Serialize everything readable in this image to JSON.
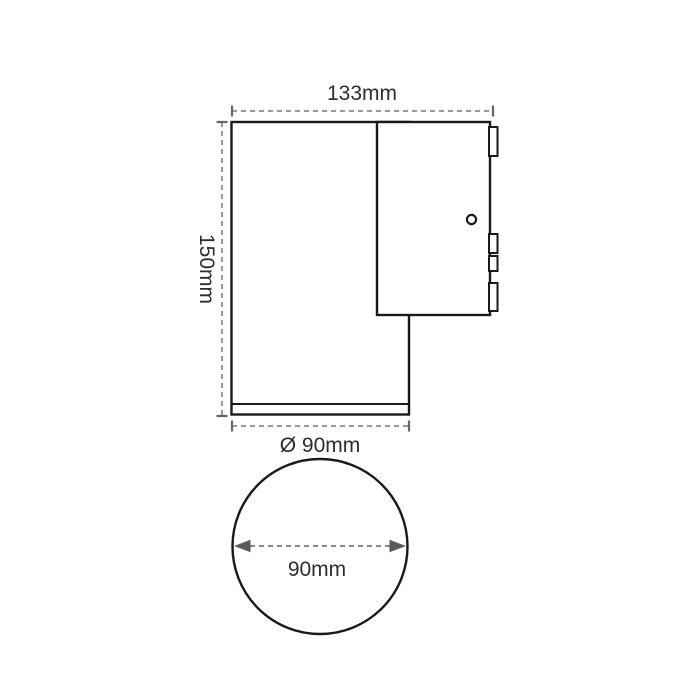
{
  "side_view": {
    "width_label": "133mm",
    "height_label": "150mm",
    "base_diameter_label": "Ø 90mm"
  },
  "front_view": {
    "diameter_label": "90mm"
  },
  "colors": {
    "background": "#ffffff",
    "outline": "#1a1a1a",
    "dimension_line": "#999999",
    "dimension_tick": "#666666",
    "arrowhead": "#5a5a5a",
    "label_text": "#2d2d2d"
  }
}
